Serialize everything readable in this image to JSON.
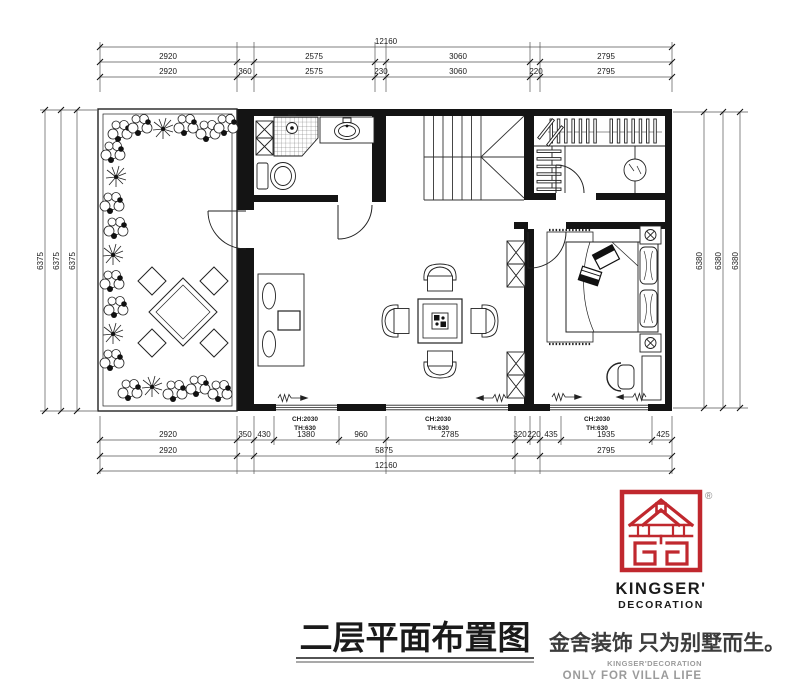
{
  "title": {
    "text": "二层平面布置图"
  },
  "branding": {
    "brand_line1": "KINGSER'",
    "brand_line2": "DECORATION",
    "registered": "®",
    "tagline_cn": "金舍装饰 只为别墅而生。",
    "tagline_sub1": "KINGSER'DECORATION",
    "tagline_sub2": "ONLY FOR VILLA LIFE",
    "colors": {
      "red": "#c0282e",
      "gray": "#9b9b9b"
    }
  },
  "plan": {
    "window_labels": [
      {
        "ch": "CH:2030",
        "th": "TH:630"
      },
      {
        "ch": "CH:2030",
        "th": "TH:630"
      },
      {
        "ch": "CH:2030",
        "th": "TH:630"
      }
    ],
    "dimensions": {
      "top_total": "12160",
      "top_row2": [
        "2920",
        "2575",
        "3060",
        "2795"
      ],
      "top_row3": [
        "2920",
        "360",
        "2575",
        "230",
        "3060",
        "220",
        "2795"
      ],
      "bottom_row1": [
        "2920",
        "350",
        "430",
        "1380",
        "960",
        "2785",
        "320",
        "220",
        "435",
        "1935",
        "425"
      ],
      "bottom_row2": [
        "2920",
        "5875",
        "2795"
      ],
      "bottom_total": "12160",
      "left": [
        "6375",
        "6375",
        "6375"
      ],
      "right": [
        "6380",
        "6380",
        "6380"
      ]
    }
  }
}
